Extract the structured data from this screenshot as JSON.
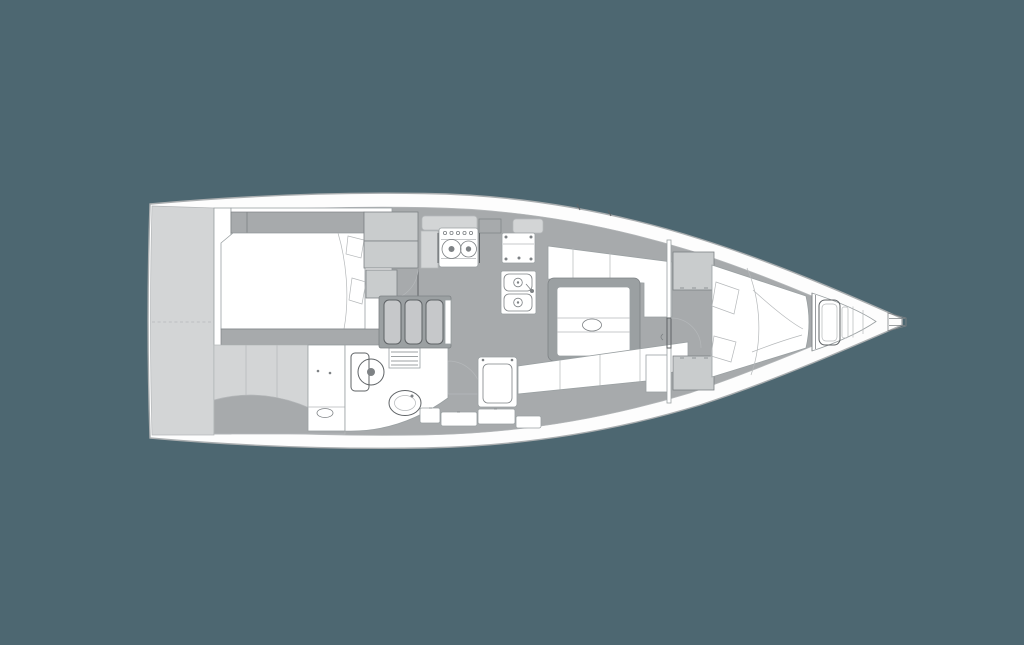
{
  "meta": {
    "subject": "sailboat-interior-layout-plan",
    "view": "top-down",
    "orientation": "stern-left-bow-right"
  },
  "colors": {
    "background": "#4d6771",
    "hull": "#fdfdfd",
    "rim_stroke": "#aaaeb0",
    "floor": "#a7aaac",
    "structure": "#9ba0a2",
    "furniture_light": "#d3d5d6",
    "cabinet": "#c9cccd",
    "tread": "#c6c8ca",
    "white": "#ffffff",
    "outline": "#9aa0a2",
    "line": "#7e8285",
    "line_light": "#b5b8ba",
    "line_dark": "#5f6366"
  },
  "features": [
    {
      "id": "hull",
      "label": "Hull and side decks"
    },
    {
      "id": "transom",
      "label": "Transom / lazarette panels"
    },
    {
      "id": "aft-cabin",
      "label": "Aft cabin double berth"
    },
    {
      "id": "aft-lockers",
      "label": "Aft cabin lockers and door"
    },
    {
      "id": "hanging-lockers",
      "label": "Hanging lockers"
    },
    {
      "id": "head",
      "label": "Head compartment"
    },
    {
      "id": "toilet",
      "label": "Marine toilet"
    },
    {
      "id": "washbasin",
      "label": "Washbasin"
    },
    {
      "id": "grating",
      "label": "Shower seat grating"
    },
    {
      "id": "steps",
      "label": "Companionway steps"
    },
    {
      "id": "galley",
      "label": "Galley"
    },
    {
      "id": "stove",
      "label": "Two-burner gimbaled stove"
    },
    {
      "id": "refrigerator",
      "label": "Top-loading refrigerator counter"
    },
    {
      "id": "sink",
      "label": "Double galley sink"
    },
    {
      "id": "saloon-table",
      "label": "Saloon folding table"
    },
    {
      "id": "port-settee",
      "label": "Port L-shaped settee"
    },
    {
      "id": "starboard-settee",
      "label": "Starboard settee"
    },
    {
      "id": "seat-module",
      "label": "Seat / locker module"
    },
    {
      "id": "forward-door",
      "label": "Forward cabin door"
    },
    {
      "id": "wardrobes",
      "label": "Forward cabin wardrobes"
    },
    {
      "id": "v-berth",
      "label": "Forward cabin V-berth"
    },
    {
      "id": "anchor-locker",
      "label": "Anchor locker"
    },
    {
      "id": "bow-fitting",
      "label": "Bow stem fitting"
    },
    {
      "id": "deck-hatches",
      "label": "Deck hatches and lockers"
    }
  ]
}
